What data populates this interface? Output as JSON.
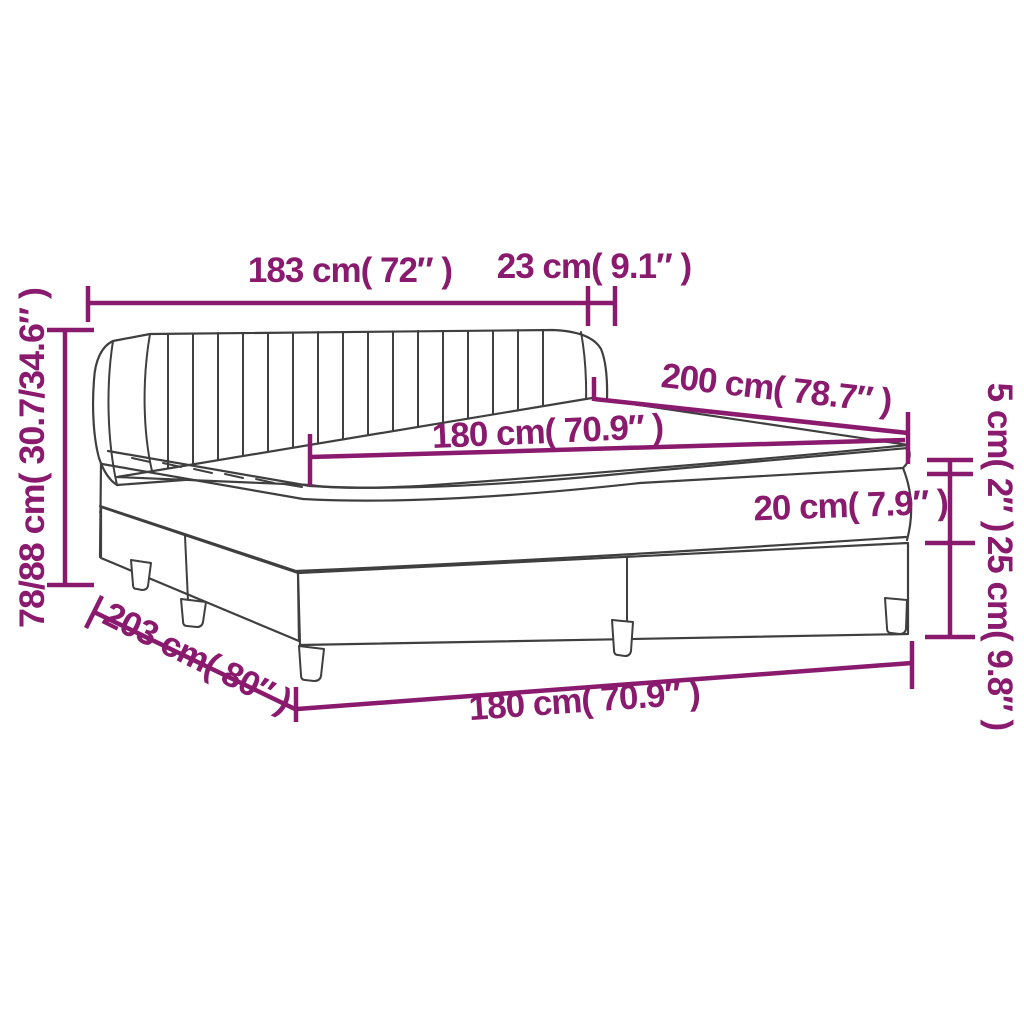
{
  "diagram": {
    "type": "product-dimension-diagram",
    "subject": "box spring bed with channel-tufted headboard, mattress and topper",
    "colors": {
      "dimension_accent": "#8A1A6D",
      "line_art": "#3F3F3F",
      "background": "#FFFFFF"
    },
    "dimensions": {
      "headboard_width": "183 cm( 72″ )",
      "headboard_wing_depth": "23 cm( 9.1″ )",
      "bed_length": "200 cm( 78.7″ )",
      "mattress_width": "180 cm( 70.9″ )",
      "mattress_height": "20 cm( 7.9″ )",
      "topper_height": "5 cm( 2″ )",
      "base_height": "25 cm( 9.8″ )",
      "total_height": "78/88 cm( 30.7/34.6″ )",
      "frame_length": "203 cm( 80″ )",
      "frame_width": "180 cm( 70.9″ )"
    }
  }
}
